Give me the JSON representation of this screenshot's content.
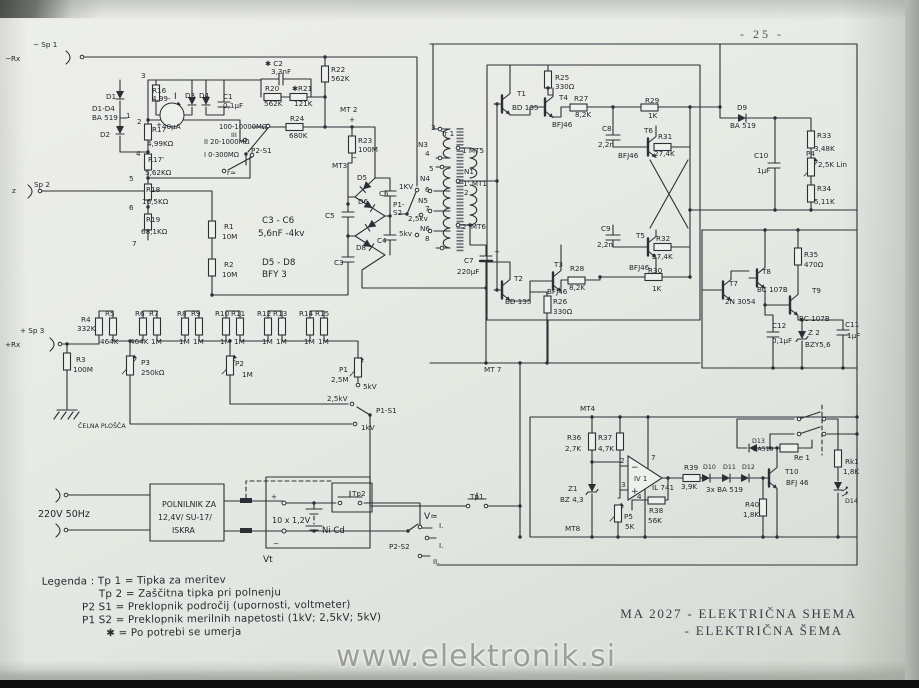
{
  "page": {
    "number": "- 25 -",
    "watermark": "www.elektronik.si",
    "title": {
      "line1": "MA 2027 - ELEKTRIČNA SHEMA",
      "line2": "- ELEKTRIČNA ŠEMA"
    }
  },
  "legend": {
    "lines": [
      "Legenda : Tp 1 = Tipka za meritev",
      "Tp 2 = Zaščitna tipka pri polnenju",
      "P2 S1 = Preklopnik področij (upornosti, voltmeter)",
      "P1 S2 = Preklopnik merilnih napetosti (1kV; 2,5kV; 5kV)",
      "✱  = Po potrebi se umerja"
    ]
  },
  "schematic": {
    "ink": "#2c3036",
    "labels": [
      {
        "t": "− Sp 1",
        "x": 33,
        "y": 47
      },
      {
        "t": "−Rx",
        "x": 5,
        "y": 61
      },
      {
        "t": "z",
        "x": 12,
        "y": 193
      },
      {
        "t": "Sp 2",
        "x": 34,
        "y": 187
      },
      {
        "t": "+ Sp 3",
        "x": 20,
        "y": 333
      },
      {
        "t": "+Rx",
        "x": 5,
        "y": 347
      },
      {
        "t": "3",
        "x": 141,
        "y": 78
      },
      {
        "t": "D1",
        "x": 106,
        "y": 99
      },
      {
        "t": "D1-D4",
        "x": 92,
        "y": 111
      },
      {
        "t": "BA 519",
        "x": 92,
        "y": 120
      },
      {
        "t": "1",
        "x": 126,
        "y": 118
      },
      {
        "t": "2",
        "x": 137,
        "y": 124
      },
      {
        "t": "D2",
        "x": 100,
        "y": 137
      },
      {
        "t": "R16",
        "x": 152,
        "y": 93
      },
      {
        "t": "4,99-",
        "x": 152,
        "y": 101
      },
      {
        "t": "I",
        "x": 174,
        "y": 99,
        "s": 9
      },
      {
        "t": "D3",
        "x": 185,
        "y": 98
      },
      {
        "t": "D4",
        "x": 199,
        "y": 98
      },
      {
        "t": "C1",
        "x": 223,
        "y": 99
      },
      {
        "t": "0,1μF",
        "x": 223,
        "y": 108
      },
      {
        "t": "+",
        "x": 156,
        "y": 127
      },
      {
        "t": "40μA",
        "x": 162,
        "y": 129
      },
      {
        "t": "R17",
        "x": 152,
        "y": 132
      },
      {
        "t": "4,99KΩ",
        "x": 147,
        "y": 146
      },
      {
        "t": "4",
        "x": 136,
        "y": 156
      },
      {
        "t": "R17'",
        "x": 148,
        "y": 162
      },
      {
        "t": "5,62KΩ",
        "x": 145,
        "y": 175
      },
      {
        "t": "5",
        "x": 129,
        "y": 181
      },
      {
        "t": "R18",
        "x": 146,
        "y": 192
      },
      {
        "t": "16,5KΩ",
        "x": 142,
        "y": 204
      },
      {
        "t": "6",
        "x": 129,
        "y": 210
      },
      {
        "t": "R19",
        "x": 146,
        "y": 222
      },
      {
        "t": "68,1KΩ",
        "x": 141,
        "y": 234
      },
      {
        "t": "7",
        "x": 132,
        "y": 246
      },
      {
        "t": "100-10000MΩ",
        "x": 219,
        "y": 129,
        "s": 6.8
      },
      {
        "t": "III",
        "x": 231,
        "y": 137,
        "s": 6.5
      },
      {
        "t": "II 20-1000MΩ",
        "x": 204,
        "y": 144,
        "s": 6.8
      },
      {
        "t": "I 0-300MΩ",
        "x": 204,
        "y": 157,
        "s": 6.8
      },
      {
        "t": "P2-S1",
        "x": 251,
        "y": 153
      },
      {
        "t": "r≃",
        "x": 227,
        "y": 175
      },
      {
        "t": "✱ C2",
        "x": 265,
        "y": 66
      },
      {
        "t": "3,3nF",
        "x": 271,
        "y": 74
      },
      {
        "t": "R20",
        "x": 265,
        "y": 91
      },
      {
        "t": "562K",
        "x": 264,
        "y": 106
      },
      {
        "t": "✱R21",
        "x": 292,
        "y": 91
      },
      {
        "t": "121K",
        "x": 294,
        "y": 106
      },
      {
        "t": "R22",
        "x": 331,
        "y": 72
      },
      {
        "t": "562K",
        "x": 331,
        "y": 81
      },
      {
        "t": "R24",
        "x": 290,
        "y": 121
      },
      {
        "t": "680K",
        "x": 289,
        "y": 138
      },
      {
        "t": "MT 2",
        "x": 340,
        "y": 112
      },
      {
        "t": "+",
        "x": 349,
        "y": 122
      },
      {
        "t": "R23",
        "x": 358,
        "y": 143
      },
      {
        "t": "100M",
        "x": 358,
        "y": 152
      },
      {
        "t": "MT3",
        "x": 332,
        "y": 168
      },
      {
        "t": "−",
        "x": 351,
        "y": 160
      },
      {
        "t": "C3 - C6",
        "x": 262,
        "y": 223,
        "s": 8.8
      },
      {
        "t": "5,6nF -4kv",
        "x": 258,
        "y": 236,
        "s": 8.8
      },
      {
        "t": "D5 - D8",
        "x": 262,
        "y": 265,
        "s": 8.8
      },
      {
        "t": "BFY 3",
        "x": 262,
        "y": 277,
        "s": 8.8
      },
      {
        "t": "D5",
        "x": 357,
        "y": 180
      },
      {
        "t": "C6",
        "x": 379,
        "y": 196
      },
      {
        "t": "D6",
        "x": 358,
        "y": 204
      },
      {
        "t": "C5",
        "x": 325,
        "y": 218
      },
      {
        "t": "C4",
        "x": 377,
        "y": 243
      },
      {
        "t": "D8",
        "x": 356,
        "y": 250
      },
      {
        "t": "C3",
        "x": 334,
        "y": 265
      },
      {
        "t": "P1-",
        "x": 393,
        "y": 207
      },
      {
        "t": "S2",
        "x": 393,
        "y": 215
      },
      {
        "t": "1KV",
        "x": 399,
        "y": 189
      },
      {
        "t": "2,5kv",
        "x": 408,
        "y": 221
      },
      {
        "t": "5kv",
        "x": 399,
        "y": 236
      },
      {
        "t": "3",
        "x": 431,
        "y": 130
      },
      {
        "t": "N3",
        "x": 418,
        "y": 147
      },
      {
        "t": "4",
        "x": 425,
        "y": 156
      },
      {
        "t": "Tr 1",
        "x": 441,
        "y": 136
      },
      {
        "t": "5",
        "x": 429,
        "y": 171
      },
      {
        "t": "N4",
        "x": 420,
        "y": 181
      },
      {
        "t": "6",
        "x": 425,
        "y": 192
      },
      {
        "t": "N5",
        "x": 418,
        "y": 203
      },
      {
        "t": "7",
        "x": 425,
        "y": 211
      },
      {
        "t": "N6",
        "x": 420,
        "y": 231
      },
      {
        "t": "8",
        "x": 425,
        "y": 241
      },
      {
        "t": "1 MT5",
        "x": 462,
        "y": 153
      },
      {
        "t": "N1",
        "x": 464,
        "y": 174
      },
      {
        "t": "1' MT1",
        "x": 463,
        "y": 186
      },
      {
        "t": "2",
        "x": 464,
        "y": 195
      },
      {
        "t": "2' MT6",
        "x": 462,
        "y": 229
      },
      {
        "t": "C7",
        "x": 464,
        "y": 263
      },
      {
        "t": "220μF",
        "x": 457,
        "y": 274
      },
      {
        "t": "+",
        "x": 494,
        "y": 254
      },
      {
        "t": "R25",
        "x": 555,
        "y": 80
      },
      {
        "t": "330Ω",
        "x": 555,
        "y": 89
      },
      {
        "t": "T1",
        "x": 517,
        "y": 96
      },
      {
        "t": "BD 135",
        "x": 512,
        "y": 110
      },
      {
        "t": "T4",
        "x": 559,
        "y": 100
      },
      {
        "t": "BFJ46",
        "x": 552,
        "y": 127
      },
      {
        "t": "R27",
        "x": 574,
        "y": 101
      },
      {
        "t": "8,2K",
        "x": 575,
        "y": 117
      },
      {
        "t": "R29",
        "x": 645,
        "y": 103
      },
      {
        "t": "1K",
        "x": 648,
        "y": 118
      },
      {
        "t": "C8",
        "x": 602,
        "y": 131
      },
      {
        "t": "2,2n",
        "x": 598,
        "y": 147
      },
      {
        "t": "T6",
        "x": 644,
        "y": 133
      },
      {
        "t": "R31",
        "x": 658,
        "y": 139
      },
      {
        "t": "27,4K",
        "x": 654,
        "y": 156
      },
      {
        "t": "BFJ46",
        "x": 618,
        "y": 158
      },
      {
        "t": "C9",
        "x": 601,
        "y": 231
      },
      {
        "t": "2,2n",
        "x": 597,
        "y": 247
      },
      {
        "t": "T5",
        "x": 636,
        "y": 238
      },
      {
        "t": "R32",
        "x": 656,
        "y": 241
      },
      {
        "t": "27,4K",
        "x": 652,
        "y": 259
      },
      {
        "t": "BFJ46",
        "x": 629,
        "y": 270
      },
      {
        "t": "R30",
        "x": 648,
        "y": 273
      },
      {
        "t": "1K",
        "x": 652,
        "y": 291
      },
      {
        "t": "T3",
        "x": 554,
        "y": 267
      },
      {
        "t": "R28",
        "x": 570,
        "y": 271
      },
      {
        "t": "8,2K",
        "x": 569,
        "y": 290
      },
      {
        "t": "BFJ46",
        "x": 547,
        "y": 294
      },
      {
        "t": "T2",
        "x": 514,
        "y": 281
      },
      {
        "t": "BD 135",
        "x": 505,
        "y": 304
      },
      {
        "t": "R26",
        "x": 553,
        "y": 304
      },
      {
        "t": "330Ω",
        "x": 553,
        "y": 314
      },
      {
        "t": "MT 7",
        "x": 484,
        "y": 372
      },
      {
        "t": "D9",
        "x": 737,
        "y": 110
      },
      {
        "t": "BA 519",
        "x": 730,
        "y": 128
      },
      {
        "t": "C10",
        "x": 754,
        "y": 158
      },
      {
        "t": "1μF",
        "x": 757,
        "y": 173
      },
      {
        "t": "R33",
        "x": 817,
        "y": 138
      },
      {
        "t": "3,48K",
        "x": 814,
        "y": 151
      },
      {
        "t": "P4",
        "x": 806,
        "y": 156
      },
      {
        "t": "2,5K Lin",
        "x": 818,
        "y": 167
      },
      {
        "t": "R34",
        "x": 817,
        "y": 191
      },
      {
        "t": "5,11K",
        "x": 814,
        "y": 204
      },
      {
        "t": "R35",
        "x": 804,
        "y": 257
      },
      {
        "t": "470Ω",
        "x": 804,
        "y": 267
      },
      {
        "t": "T8",
        "x": 762,
        "y": 274
      },
      {
        "t": "BC 107B",
        "x": 757,
        "y": 292
      },
      {
        "t": "T7",
        "x": 729,
        "y": 286
      },
      {
        "t": "2N 3054",
        "x": 725,
        "y": 304
      },
      {
        "t": "T9",
        "x": 812,
        "y": 293
      },
      {
        "t": "BC 107B",
        "x": 799,
        "y": 321
      },
      {
        "t": "C12",
        "x": 772,
        "y": 328
      },
      {
        "t": "0,1μF",
        "x": 772,
        "y": 343
      },
      {
        "t": "Z 2",
        "x": 808,
        "y": 335
      },
      {
        "t": "BZY5,6",
        "x": 805,
        "y": 347
      },
      {
        "t": "C11",
        "x": 845,
        "y": 327
      },
      {
        "t": "1μF",
        "x": 847,
        "y": 338
      },
      {
        "t": "MT4",
        "x": 580,
        "y": 411
      },
      {
        "t": "R36",
        "x": 567,
        "y": 440
      },
      {
        "t": "2,7K",
        "x": 565,
        "y": 451
      },
      {
        "t": "R37",
        "x": 598,
        "y": 440
      },
      {
        "t": "4,7K",
        "x": 598,
        "y": 451
      },
      {
        "t": "Z1",
        "x": 568,
        "y": 491
      },
      {
        "t": "BZ 4,3",
        "x": 560,
        "y": 502
      },
      {
        "t": "2",
        "x": 620,
        "y": 463
      },
      {
        "t": "3",
        "x": 621,
        "y": 487
      },
      {
        "t": "−",
        "x": 631,
        "y": 470,
        "s": 9
      },
      {
        "t": "+",
        "x": 631,
        "y": 494,
        "s": 9
      },
      {
        "t": "IV 1",
        "x": 634,
        "y": 481,
        "s": 6.8
      },
      {
        "t": "7",
        "x": 651,
        "y": 460
      },
      {
        "t": "4",
        "x": 637,
        "y": 499
      },
      {
        "t": "IL 741",
        "x": 652,
        "y": 490
      },
      {
        "t": "P5",
        "x": 624,
        "y": 519
      },
      {
        "t": "5K",
        "x": 625,
        "y": 529
      },
      {
        "t": "R38",
        "x": 649,
        "y": 513
      },
      {
        "t": "56K",
        "x": 648,
        "y": 523
      },
      {
        "t": "R39",
        "x": 684,
        "y": 470
      },
      {
        "t": "3,9K",
        "x": 681,
        "y": 489
      },
      {
        "t": "D10",
        "x": 703,
        "y": 469,
        "s": 6.3
      },
      {
        "t": "D11",
        "x": 723,
        "y": 469,
        "s": 6.3
      },
      {
        "t": "D12",
        "x": 742,
        "y": 469,
        "s": 6.3
      },
      {
        "t": "3x BA 519",
        "x": 706,
        "y": 492
      },
      {
        "t": "D13",
        "x": 752,
        "y": 443,
        "s": 6.3
      },
      {
        "t": "BA519",
        "x": 753,
        "y": 451,
        "s": 6.3
      },
      {
        "t": "Re 1",
        "x": 794,
        "y": 460
      },
      {
        "t": "T10",
        "x": 785,
        "y": 474
      },
      {
        "t": "BFJ 46",
        "x": 786,
        "y": 485
      },
      {
        "t": "R40",
        "x": 745,
        "y": 507
      },
      {
        "t": "1,8K",
        "x": 743,
        "y": 517
      },
      {
        "t": "Rk1",
        "x": 845,
        "y": 464
      },
      {
        "t": "1,8K",
        "x": 843,
        "y": 474
      },
      {
        "t": "D14",
        "x": 845,
        "y": 503,
        "s": 6.3
      },
      {
        "t": "MT8",
        "x": 565,
        "y": 531
      },
      {
        "t": "220V 50Hz",
        "x": 38,
        "y": 517,
        "s": 9.5
      },
      {
        "t": "POLNILNIK ZA",
        "x": 162,
        "y": 507,
        "s": 7.8
      },
      {
        "t": "12,4V/ SU-17/",
        "x": 158,
        "y": 520,
        "s": 7.8
      },
      {
        "t": "ISKRA",
        "x": 172,
        "y": 533,
        "s": 7.8
      },
      {
        "t": "+",
        "x": 271,
        "y": 499
      },
      {
        "t": "10 x 1,2V",
        "x": 272,
        "y": 523,
        "s": 8
      },
      {
        "t": "Ni Cd",
        "x": 322,
        "y": 533,
        "s": 8.5
      },
      {
        "t": "−",
        "x": 273,
        "y": 546
      },
      {
        "t": "Vt",
        "x": 263,
        "y": 562,
        "s": 9
      },
      {
        "t": "Tp2",
        "x": 352,
        "y": 496
      },
      {
        "t": "Tp1",
        "x": 470,
        "y": 499
      },
      {
        "t": "V≃",
        "x": 424,
        "y": 519,
        "s": 9
      },
      {
        "t": "P2-S2",
        "x": 389,
        "y": 549
      },
      {
        "t": "I.",
        "x": 439,
        "y": 528
      },
      {
        "t": "I.",
        "x": 439,
        "y": 548
      },
      {
        "t": "II.",
        "x": 433,
        "y": 564
      },
      {
        "t": "R1",
        "x": 224,
        "y": 229
      },
      {
        "t": "10M",
        "x": 222,
        "y": 239
      },
      {
        "t": "R2",
        "x": 224,
        "y": 267
      },
      {
        "t": "10M",
        "x": 222,
        "y": 277
      },
      {
        "t": "R3",
        "x": 76,
        "y": 362
      },
      {
        "t": "100M",
        "x": 73,
        "y": 372
      },
      {
        "t": "R4",
        "x": 81,
        "y": 322
      },
      {
        "t": "332K",
        "x": 77,
        "y": 331
      },
      {
        "t": "R5",
        "x": 105,
        "y": 316
      },
      {
        "t": "464K",
        "x": 100,
        "y": 344
      },
      {
        "t": "R6",
        "x": 135,
        "y": 316
      },
      {
        "t": "464K",
        "x": 130,
        "y": 344
      },
      {
        "t": "R7",
        "x": 149,
        "y": 316
      },
      {
        "t": "1M",
        "x": 151,
        "y": 344
      },
      {
        "t": "R8",
        "x": 177,
        "y": 316
      },
      {
        "t": "1M",
        "x": 179,
        "y": 344
      },
      {
        "t": "R9",
        "x": 191,
        "y": 316
      },
      {
        "t": "1M",
        "x": 193,
        "y": 344
      },
      {
        "t": "R10",
        "x": 215,
        "y": 316
      },
      {
        "t": "1M",
        "x": 220,
        "y": 344
      },
      {
        "t": "R11",
        "x": 231,
        "y": 316
      },
      {
        "t": "1M",
        "x": 234,
        "y": 344
      },
      {
        "t": "R12",
        "x": 257,
        "y": 316
      },
      {
        "t": "1M",
        "x": 262,
        "y": 344
      },
      {
        "t": "R13",
        "x": 273,
        "y": 316
      },
      {
        "t": "1M",
        "x": 276,
        "y": 344
      },
      {
        "t": "R14",
        "x": 299,
        "y": 316
      },
      {
        "t": "1M",
        "x": 304,
        "y": 344
      },
      {
        "t": "R15",
        "x": 315,
        "y": 316
      },
      {
        "t": "1M",
        "x": 318,
        "y": 344
      },
      {
        "t": "P3",
        "x": 141,
        "y": 365
      },
      {
        "t": "250kΩ",
        "x": 141,
        "y": 375
      },
      {
        "t": "P2",
        "x": 235,
        "y": 366
      },
      {
        "t": "1M",
        "x": 242,
        "y": 377
      },
      {
        "t": "P1",
        "x": 339,
        "y": 372
      },
      {
        "t": "2,5M",
        "x": 331,
        "y": 382
      },
      {
        "t": "5kV",
        "x": 363,
        "y": 389
      },
      {
        "t": "2,5kV",
        "x": 327,
        "y": 401
      },
      {
        "t": "1kV",
        "x": 361,
        "y": 430
      },
      {
        "t": "P1-S1",
        "x": 376,
        "y": 413
      },
      {
        "t": "ČELNA PLOŠČA",
        "x": 78,
        "y": 428,
        "s": 6.3
      }
    ]
  }
}
